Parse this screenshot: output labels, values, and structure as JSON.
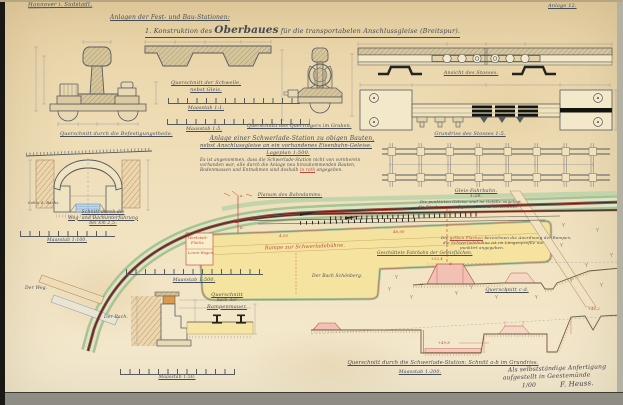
{
  "sheet": {
    "corner_note": "Hannover i. Südstadt.",
    "sheet_no": "Anlage 12.",
    "title_line": "Anlagen der Fest- und Bau-Stationen:",
    "subtitle_pre": "1. Konstruktion des ",
    "subtitle_big": "Oberbaues",
    "subtitle_post": " für die transportabelen Anschlussgleise (Breitspur)."
  },
  "details": {
    "fastening_caption": "Querschnitt durch die Befestigungstheile.",
    "sleeper_caption1": "Querschnitt der Schwelle,",
    "sleeper_caption2": "nebst Gleis.",
    "scale_1_1": "Maasstab 1:1.",
    "scale_1_5": "Maasstab 1:5.",
    "girder_caption": "Querschnitt des Querträgers im Graben.",
    "joint_view_caption": "Ansicht des Stosses.",
    "joint_plan_caption": "Grundriss des Stosses 1:5.",
    "track_caption1": "Gleis-Fahrbahn.",
    "track_caption2": "1:20.",
    "track_note1": "Die punktirten Geleise sind im Gefälle angelegt,",
    "track_note2": "die Böschungen auf gutem Damme verschüttet."
  },
  "station": {
    "head1": "Anlage einer Schwerlade-Station zu obigen Bauten,",
    "head2": "nebst Anschlussgleise an ein vorhandenes Eisenbahn-Geleise.",
    "head3": "Lageplan 1:500.",
    "note1": "Es ist angenommen, dass die Schwerlade-Station nicht von vornherein",
    "note2": "vorhanden war; alle durch die Anlage neu hinzukommenden Bauten,",
    "note3_pre": "Bodenmassen und Entnahmen sind deshalb ",
    "note3_red": "in roth",
    "note3_post": " angegeben."
  },
  "tunnel": {
    "caption1": "Schnitt durch die",
    "caption2": "Weg- und Bachunterführung",
    "caption3": "bei km 2,5.",
    "side_label": "Sohle d. Bachs.",
    "scale": "Maasstab 1:100."
  },
  "plan": {
    "embankment_caption": "Planum des Bahndamms.",
    "bach_label": "Der Bach Schönberg.",
    "weg_label": "Der Weg.",
    "bach2_label": "Der Bach.",
    "ramp_label": "Rampe zur Schwerladebühne.",
    "werkstatt1": "Werkstatt-",
    "werkstatt2": "Fläche.",
    "loren": "Loren-Wagen.",
    "dim1": "46,00",
    "dim2": "4,50",
    "sec_a": "a.",
    "sec_b": "b.",
    "sec_c": "c.",
    "sec_d": "d.",
    "scale": "Maasstab 1:500.",
    "fill_caption": "Geschüttete Fahrbahn der Geleisflächen.",
    "legend1_pre": "Die ",
    "legend1_red": "gelben Flächen",
    "legend1_post": " bezeichnen die Anordnung der Rampen,",
    "legend2": "die Schwerladebühne ist im Längenprofile nur",
    "legend3": "punktirt angegeben."
  },
  "rampwall": {
    "caption1": "Querschnitt",
    "caption2": "nach der",
    "caption3": "Rampenmauer.",
    "scale": "Maasstab 1:50."
  },
  "profiles": {
    "cd_caption": "Querschnitt c-d.",
    "ab_caption": "Querschnitt durch die Schwerlade-Station: Schnitt a-b im Grundriss.",
    "ab_scale": "Maasstab 1:200.",
    "lvl1": "+52,4",
    "lvl2": "+49,8",
    "lvl3": "+46,2"
  },
  "signature": {
    "line1": "Als selbstständige Anfertigung",
    "line2": "aufgestellt in Geestemünde",
    "date": "1/00",
    "name": "F. Heuss."
  }
}
